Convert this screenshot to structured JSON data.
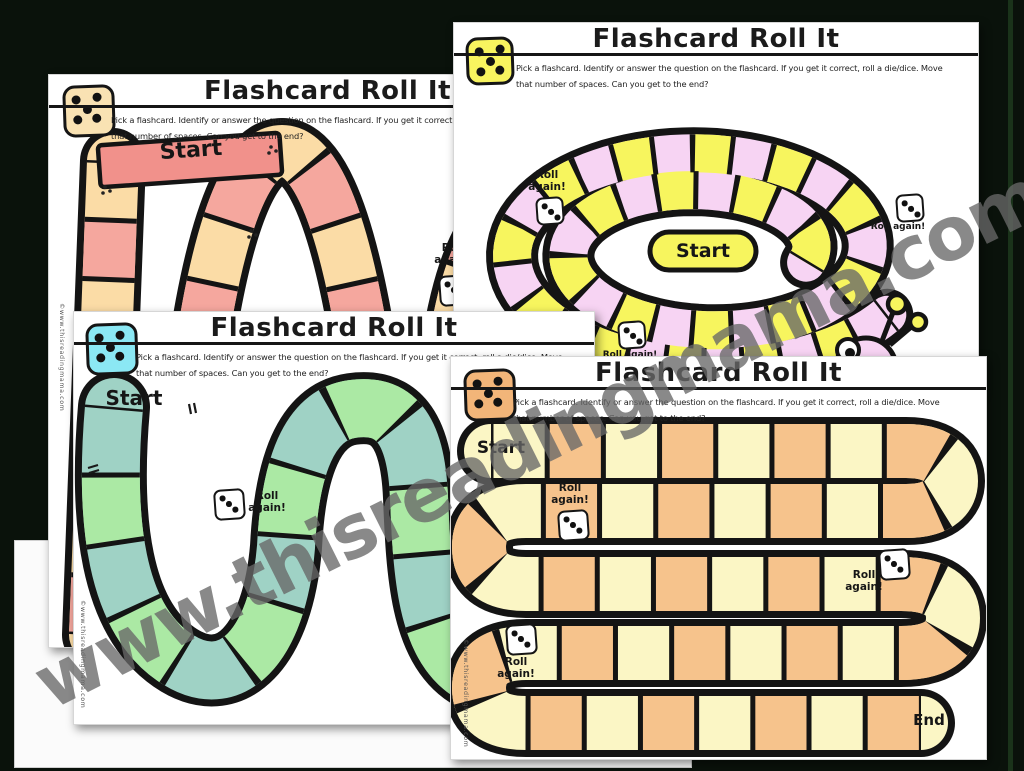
{
  "background": {
    "color": "#0a120b",
    "accent_stripe": "#1e3a1e"
  },
  "watermark": {
    "text": "www.thisreadingmama.com"
  },
  "copyright_text": "©www.thisreadingmama.com",
  "shared": {
    "title": "Flashcard Roll It",
    "instructions_line1": "Pick a flashcard. Identify or answer the question on the flashcard. If you get it correct, roll a die/dice. Move",
    "instructions_line2": "that number of spaces. Can you get to the end?",
    "start_label": "Start",
    "end_label": "End",
    "roll_again_line1": "Roll",
    "roll_again_line2": "again!",
    "roll_again_single": "Roll again!"
  },
  "pages": [
    {
      "name": "peach-zigzag-board",
      "die_color": "#F9E2B3",
      "colors": {
        "a": "#FBDCA6",
        "b": "#F5A79E",
        "banner": "#F1918B"
      }
    },
    {
      "name": "snail-spiral-board",
      "die_color": "#F8F45F",
      "colors": {
        "a": "#F7D4F3",
        "b": "#F7F55E",
        "capsule": "#F7F55E",
        "snail": "#F7D4F3",
        "antenna": "#F7F55E"
      }
    },
    {
      "name": "green-w-board",
      "die_color": "#8BE8F4",
      "colors": {
        "a": "#9FD2C5",
        "b": "#ABE9A4",
        "ribbon": "#4ED9ED"
      }
    },
    {
      "name": "orange-serpentine-board",
      "die_color": "#F2B579",
      "colors": {
        "a": "#FBF6C5",
        "b": "#F6C38C"
      }
    }
  ]
}
